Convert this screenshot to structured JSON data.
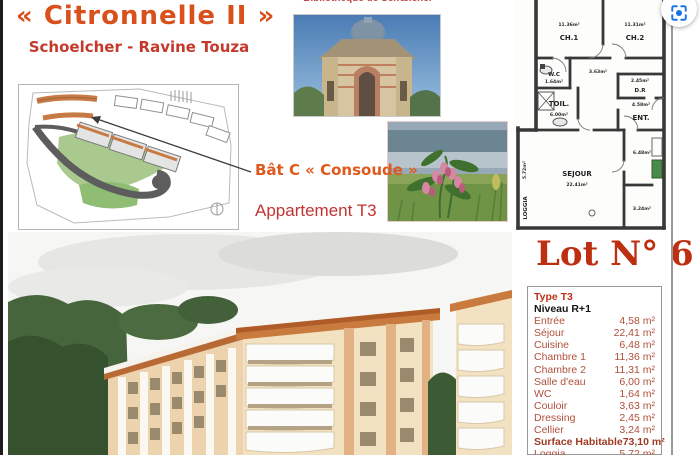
{
  "header": {
    "title": "« Citronnelle II »",
    "subtitle": "Schoelcher - Ravine Touza",
    "library_caption": "Bibliothèque de Schœlcher"
  },
  "labels": {
    "building": "Bât C « Consoude »",
    "apartment": "Appartement T3"
  },
  "lot": {
    "title": "Lot N° 6"
  },
  "floor_plan": {
    "ch1_name": "CH.1",
    "ch1_area": "11.36m²",
    "ch2_name": "CH.2",
    "ch2_area": "11.31m²",
    "wc_name": "W.C",
    "wc_area": "1.64m²",
    "toil_name": "TOIL.",
    "toil_area": "6.00m²",
    "dr_name": "D.R",
    "dr_area": "2.45m²",
    "ent_name": "ENT.",
    "ent_area": "4.58m²",
    "sejour_name": "SEJOUR",
    "sejour_area": "22.41m²",
    "loggia_name": "LOGGIA",
    "loggia_area": "5.72m²",
    "couloir_area": "3.63m²",
    "cuisine_area": "6.48m²",
    "cellier_area": "3.24m²"
  },
  "surface_table": {
    "type_label": "Type T3",
    "level_label": "Niveau R+1",
    "rows": [
      {
        "label": "Entrée",
        "value": "4,58 m²"
      },
      {
        "label": "Séjour",
        "value": "22,41 m²"
      },
      {
        "label": "Cuisine",
        "value": "6,48 m²"
      },
      {
        "label": "Chambre 1",
        "value": "11,36 m²"
      },
      {
        "label": "Chambre 2",
        "value": "11,31 m²"
      },
      {
        "label": "Salle d'eau",
        "value": "6,00 m²"
      },
      {
        "label": "WC",
        "value": "1,64 m²"
      },
      {
        "label": "Couloir",
        "value": "3,63 m²"
      },
      {
        "label": "Dressing",
        "value": "2,45 m²"
      },
      {
        "label": "Cellier",
        "value": "3,24 m²"
      },
      {
        "label": "Surface Habitable",
        "value": "73,10 m²"
      },
      {
        "label": "Loggia",
        "value": "5,72 m²"
      },
      {
        "label": "Surface totale",
        "value": "78,82 m²"
      }
    ]
  },
  "colors": {
    "title_orange": "#d8511c",
    "subtitle_red": "#c5392b",
    "lot_red": "#be2f12",
    "table_text": "#b0503c",
    "lens_blue": "#1a73e8"
  }
}
